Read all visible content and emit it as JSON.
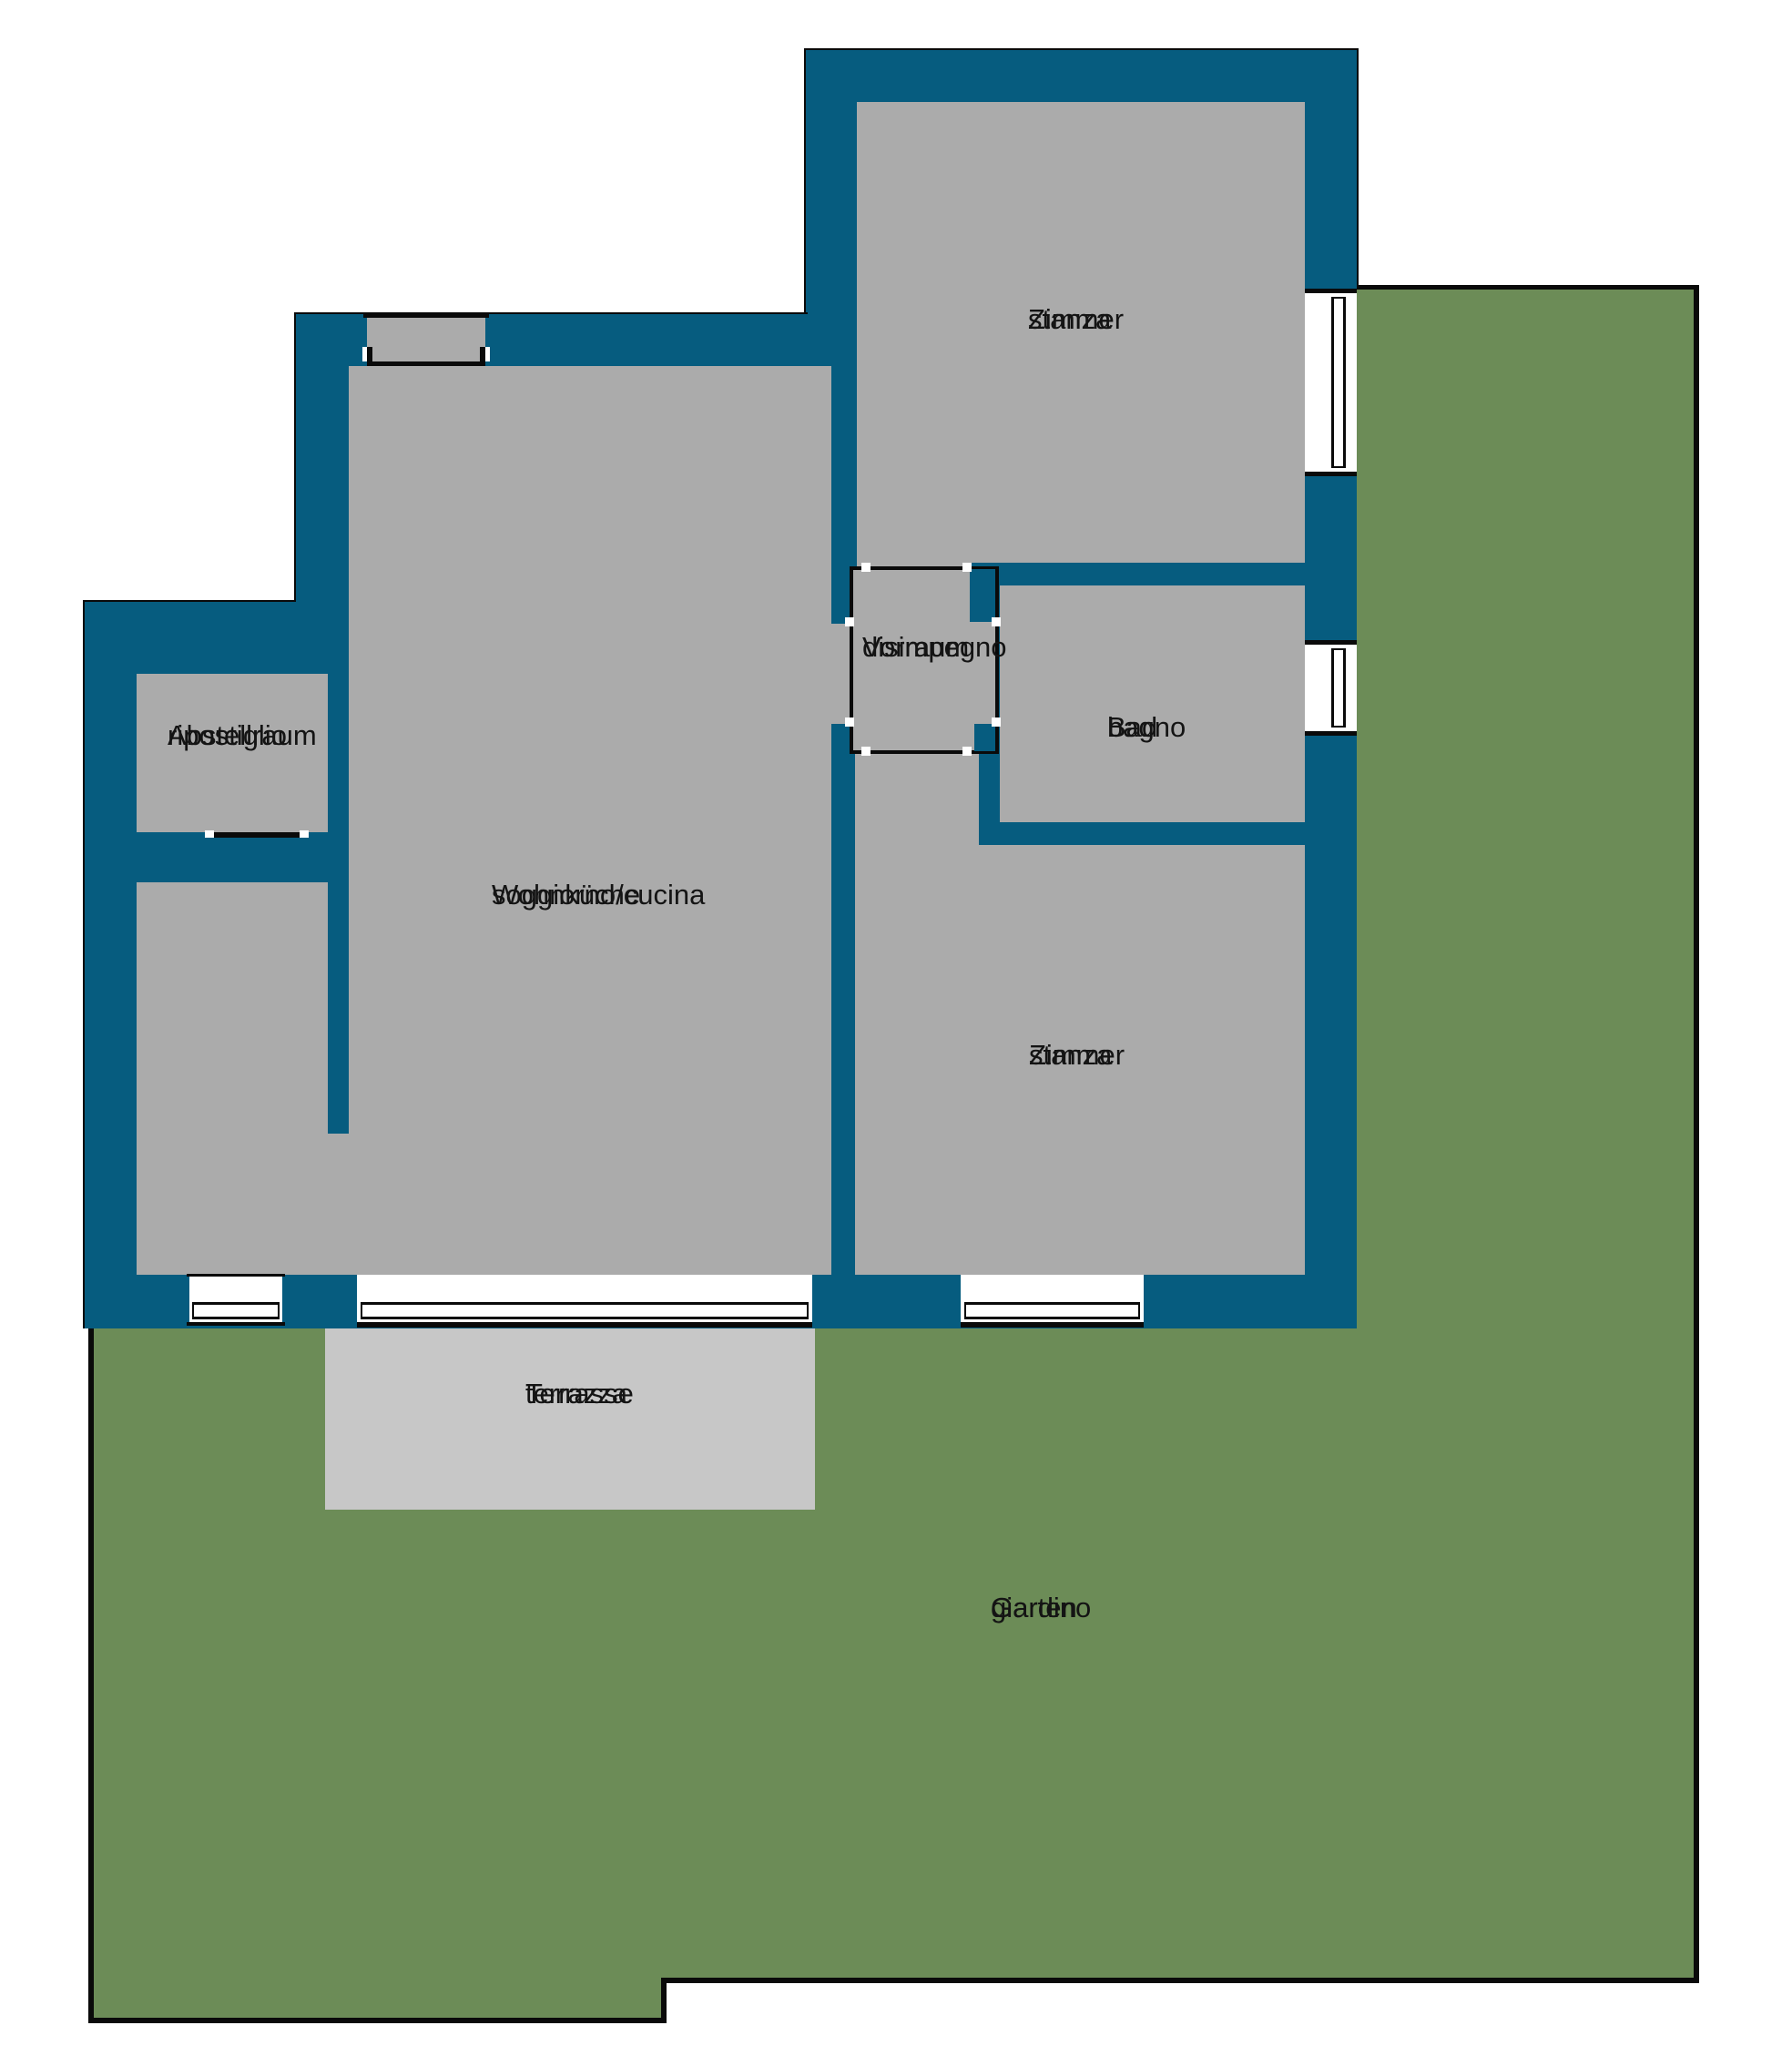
{
  "title": "Apartment floor plan with garden",
  "colors": {
    "wall": "#065C7F",
    "room": "#ABABAB",
    "terrace": "#C7C7C7",
    "garden": "#6C8C57",
    "outline": "#0A0A0A",
    "background": "#FFFFFF",
    "text": "#141414"
  },
  "rooms": {
    "zimmer_top": {
      "line1": "Zimmer",
      "line2": "stanza"
    },
    "vorraum": {
      "line1": "Vorraum",
      "line2": "disimpegno"
    },
    "bad": {
      "line1": "Bad",
      "line2": "bagno"
    },
    "wohnkueche": {
      "line1": "Wohnküche",
      "line2": "soggiorno/cucina"
    },
    "abstellraum": {
      "line1": "Abstellraum",
      "line2": "ripostiglio"
    },
    "zimmer_bottom": {
      "line1": "Zimmer",
      "line2": "stanza"
    },
    "terrasse": {
      "line1": "Terrasse",
      "line2": "terrazza"
    },
    "garten": {
      "line1": "Garten",
      "line2": "giardino"
    }
  }
}
